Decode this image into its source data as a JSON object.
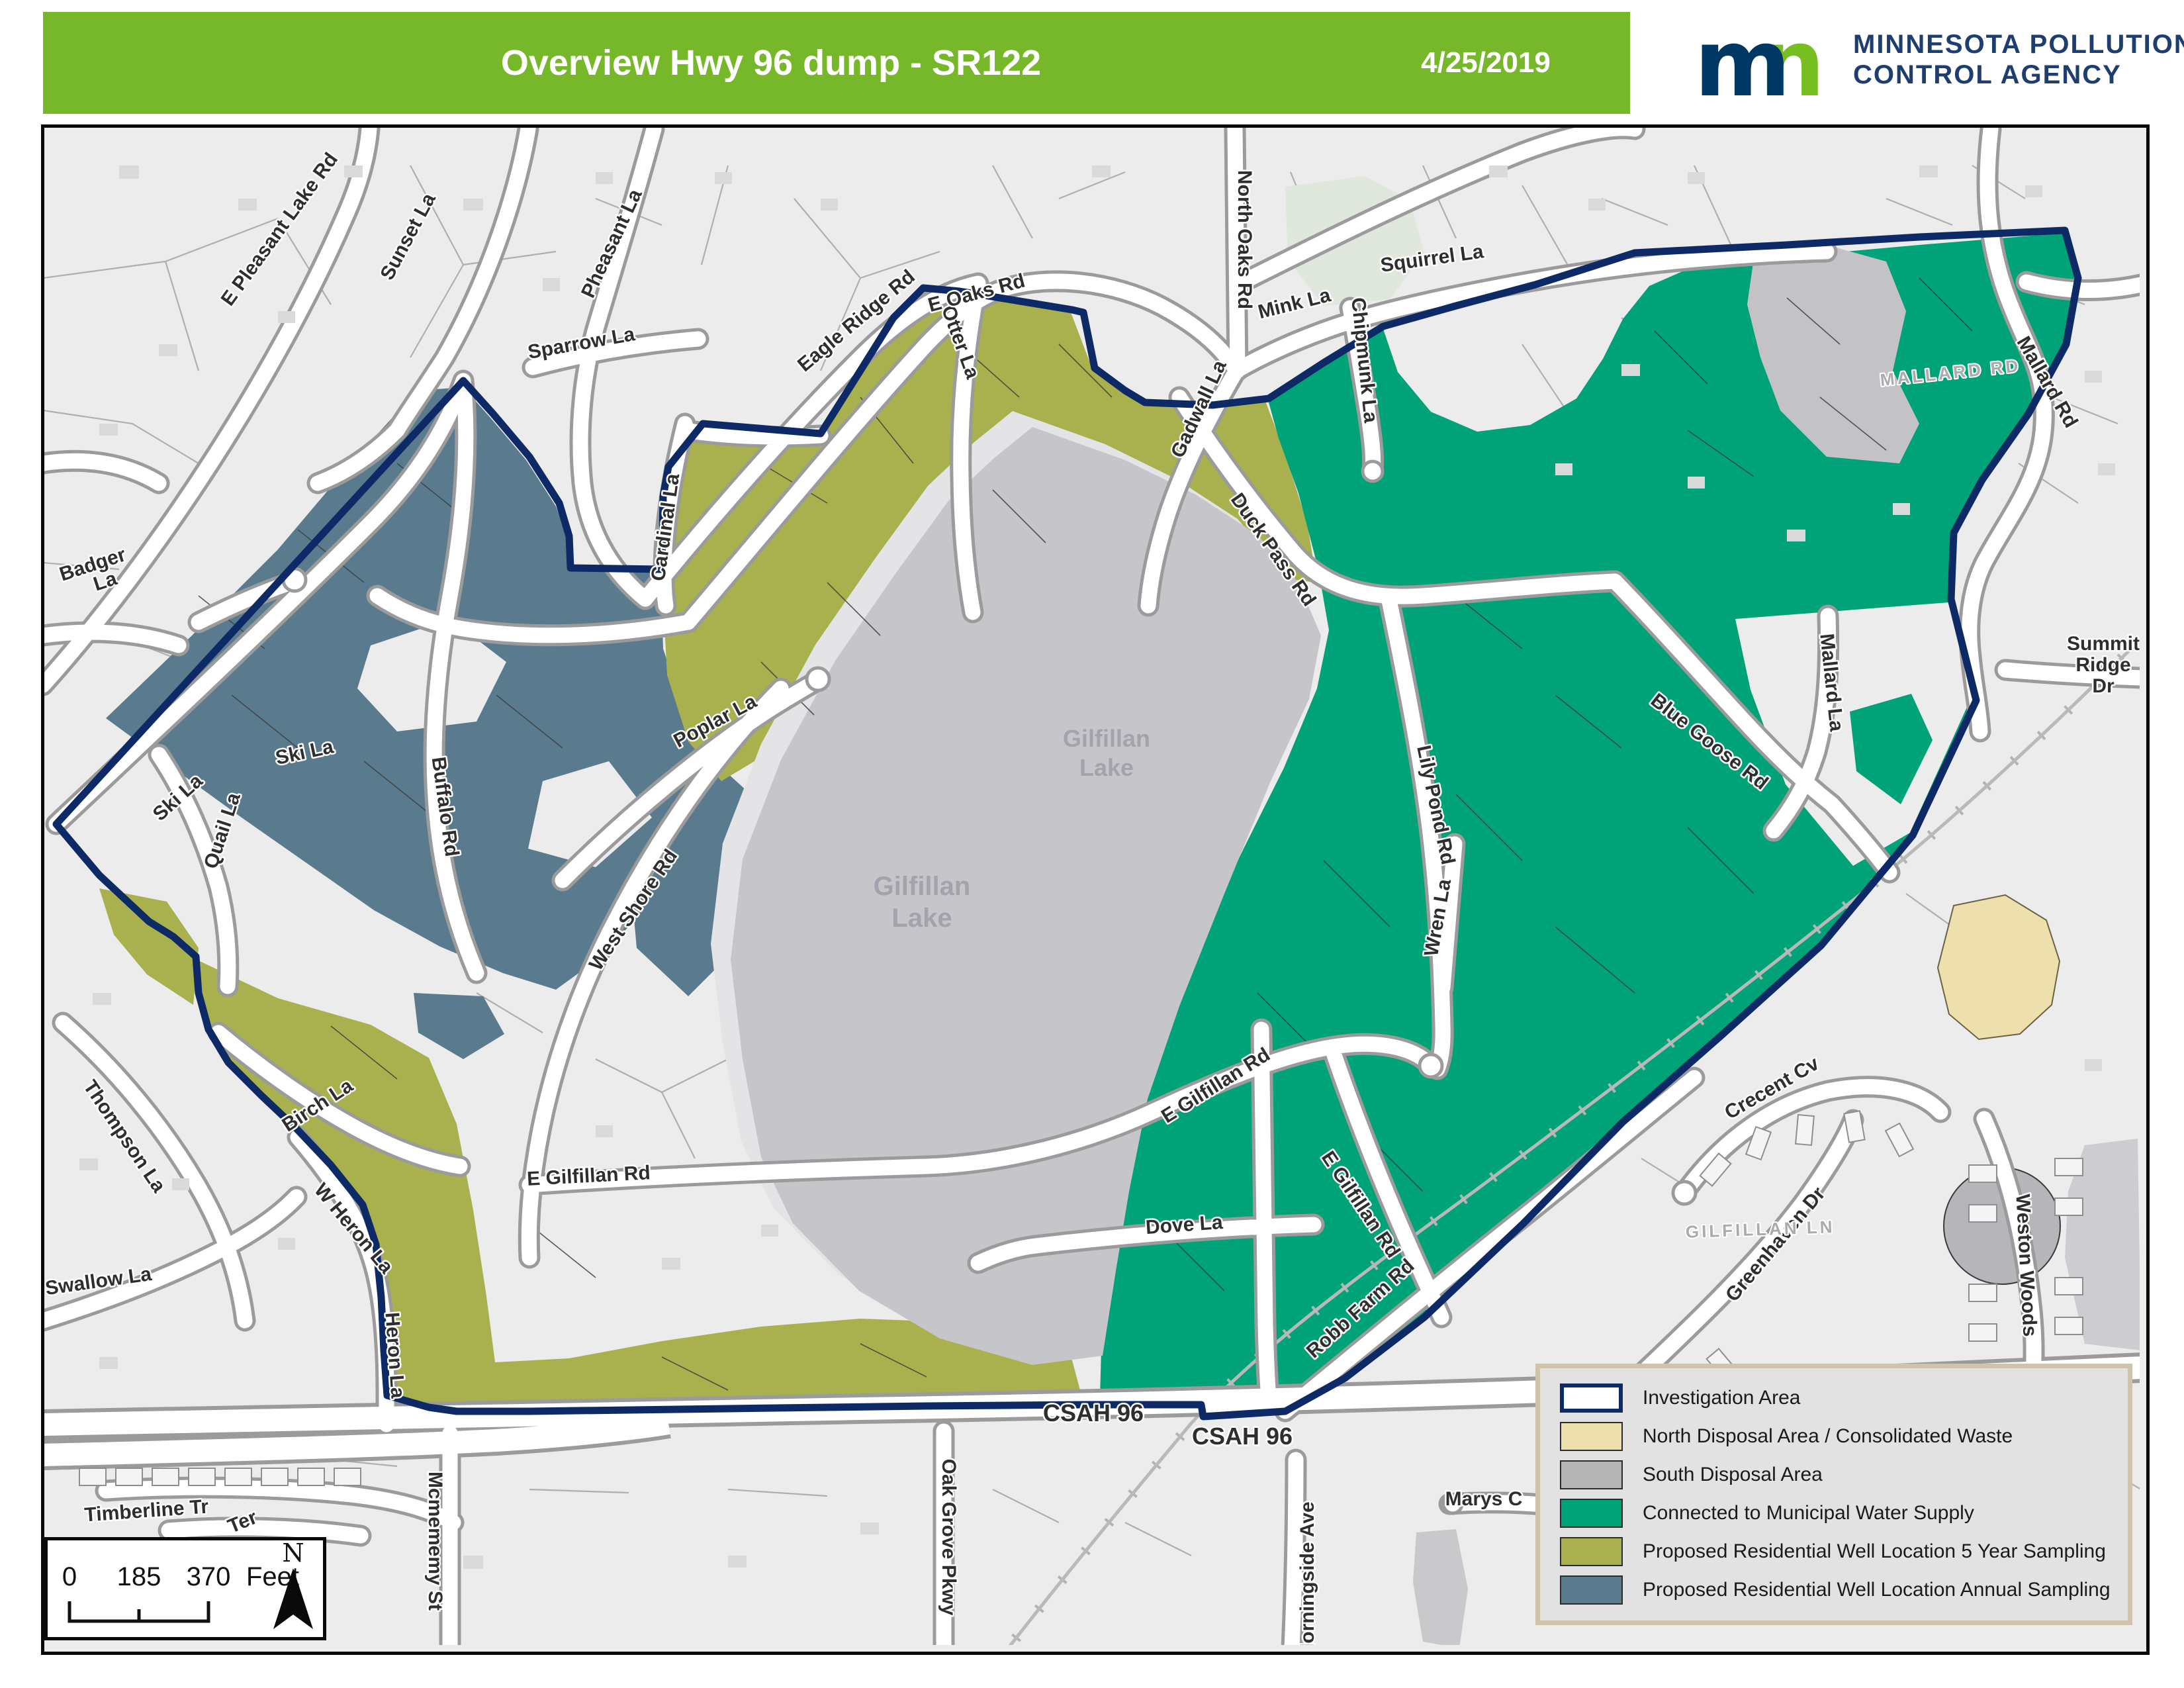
{
  "header": {
    "title": "Overview Hwy 96 dump - SR122",
    "date": "4/25/2019",
    "logo_m": "m",
    "logo_n": "n",
    "agency_line1": "MINNESOTA POLLUTION",
    "agency_line2": "CONTROL AGENCY"
  },
  "legend": {
    "items": [
      {
        "label": "Investigation Area",
        "swatch_style": "background:#ffffff;border:6px solid #0e2a66"
      },
      {
        "label": "North Disposal Area / Consolidated Waste",
        "swatch_style": "background:#eee0ac;border:2px solid #2c2c2c"
      },
      {
        "label": "South Disposal Area",
        "swatch_style": "background:#b5b5b5;border:2px solid #2c2c2c"
      },
      {
        "label": "Connected to Municipal Water Supply",
        "swatch_style": "background:#00a378;border:2px solid #2c2c2c"
      },
      {
        "label": "Proposed Residential Well Location 5 Year Sampling",
        "swatch_style": "background:#a9b14e;border:2px solid #2c2c2c"
      },
      {
        "label": "Proposed Residential Well Location Annual Sampling",
        "swatch_style": "background:#5a7b8e;border:2px solid #2c2c2c"
      }
    ]
  },
  "scale_bar": {
    "left": "0",
    "mid": "185",
    "right": "370",
    "unit": "Feet",
    "north": "N"
  },
  "map": {
    "colors": {
      "header_green": "#76b82a",
      "logo_navy": "#003865",
      "logo_green": "#78be21",
      "investigation_outline": "#0e2a66",
      "north_disposal": "#eee0ac",
      "south_disposal": "#c6c6ca",
      "municipal_water": "#00a378",
      "well_5yr_sampling": "#a9b14e",
      "well_annual_sampling": "#5a7b8e",
      "map_background": "#ececec"
    },
    "labels": {
      "e_pleasant_lake_rd": "E Pleasant Lake Rd",
      "sunset_la": "Sunset La",
      "sparrow_la": "Sparrow La",
      "pheasant_la": "Pheasant La",
      "eagle_ridge_rd": "Eagle Ridge Rd",
      "otter_la": "Otter La",
      "e_oaks_rd": "E Oaks Rd",
      "north_oaks_rd": "North Oaks Rd",
      "mink_la": "Mink La",
      "chipmunk_la": "Chipmunk La",
      "squirrel_la": "Squirrel La",
      "gadwall_la": "Gadwall La",
      "duck_pass_rd": "Duck Pass Rd",
      "badger_line1": "Badger",
      "badger_line2": "La",
      "ski_la_road": "Ski La",
      "ski_la_culdesac": "Ski La",
      "buffalo_rd": "Buffalo Rd",
      "quail_la": "Quail La",
      "cardinal_la": "Cardinal La",
      "poplar_la": "Poplar La",
      "west_shore_rd": "West Shore Rd",
      "birch_la": "Birch La",
      "w_heron_la": "W Heron La",
      "heron_la": "Heron La",
      "thompson_la": "Thompson La",
      "swallow_la": "Swallow La",
      "timberline_tr": "Timberline Tr",
      "ter": "Ter",
      "mcmememy_st": "Mcmememy St",
      "oak_grove_pkwy": "Oak Grove Pkwy",
      "morningside_ave": "Morningside Ave",
      "csah_96_a": "CSAH 96",
      "csah_96_b": "CSAH 96",
      "marys_c": "Marys C",
      "robb_farm_rd": "Robb Farm Rd",
      "dove_la": "Dove La",
      "e_gilfillan_rd_a": "E Gilfillan Rd",
      "e_gilfillan_rd_b": "E Gilfillan Rd",
      "e_gilfillan_rd_c": "E Gilfillan Rd",
      "wren_la": "Wren La",
      "lily_pond_rd": "Lily Pond Rd",
      "blue_goose_rd": "Blue Goose Rd",
      "mallard_la": "Mallard La",
      "mallard_rd": "Mallard Rd",
      "mallard_rd_faint": "MALLARD RD",
      "summit_line1": "Summit",
      "summit_line2": "Ridge",
      "summit_line3": "Dr",
      "crecent_cv": "Crecent Cv",
      "greenhaven_dr": "Greenhaven Dr",
      "weston_woods": "Weston Woods",
      "gilfillan_lake_1_line1": "Gilfillan",
      "gilfillan_lake_1_line2": "Lake",
      "gilfillan_lake_2_line1": "Gilfillan",
      "gilfillan_lake_2_line2": "Lake",
      "gilfillan_ln_faint": "GILFILLAN LN"
    }
  }
}
